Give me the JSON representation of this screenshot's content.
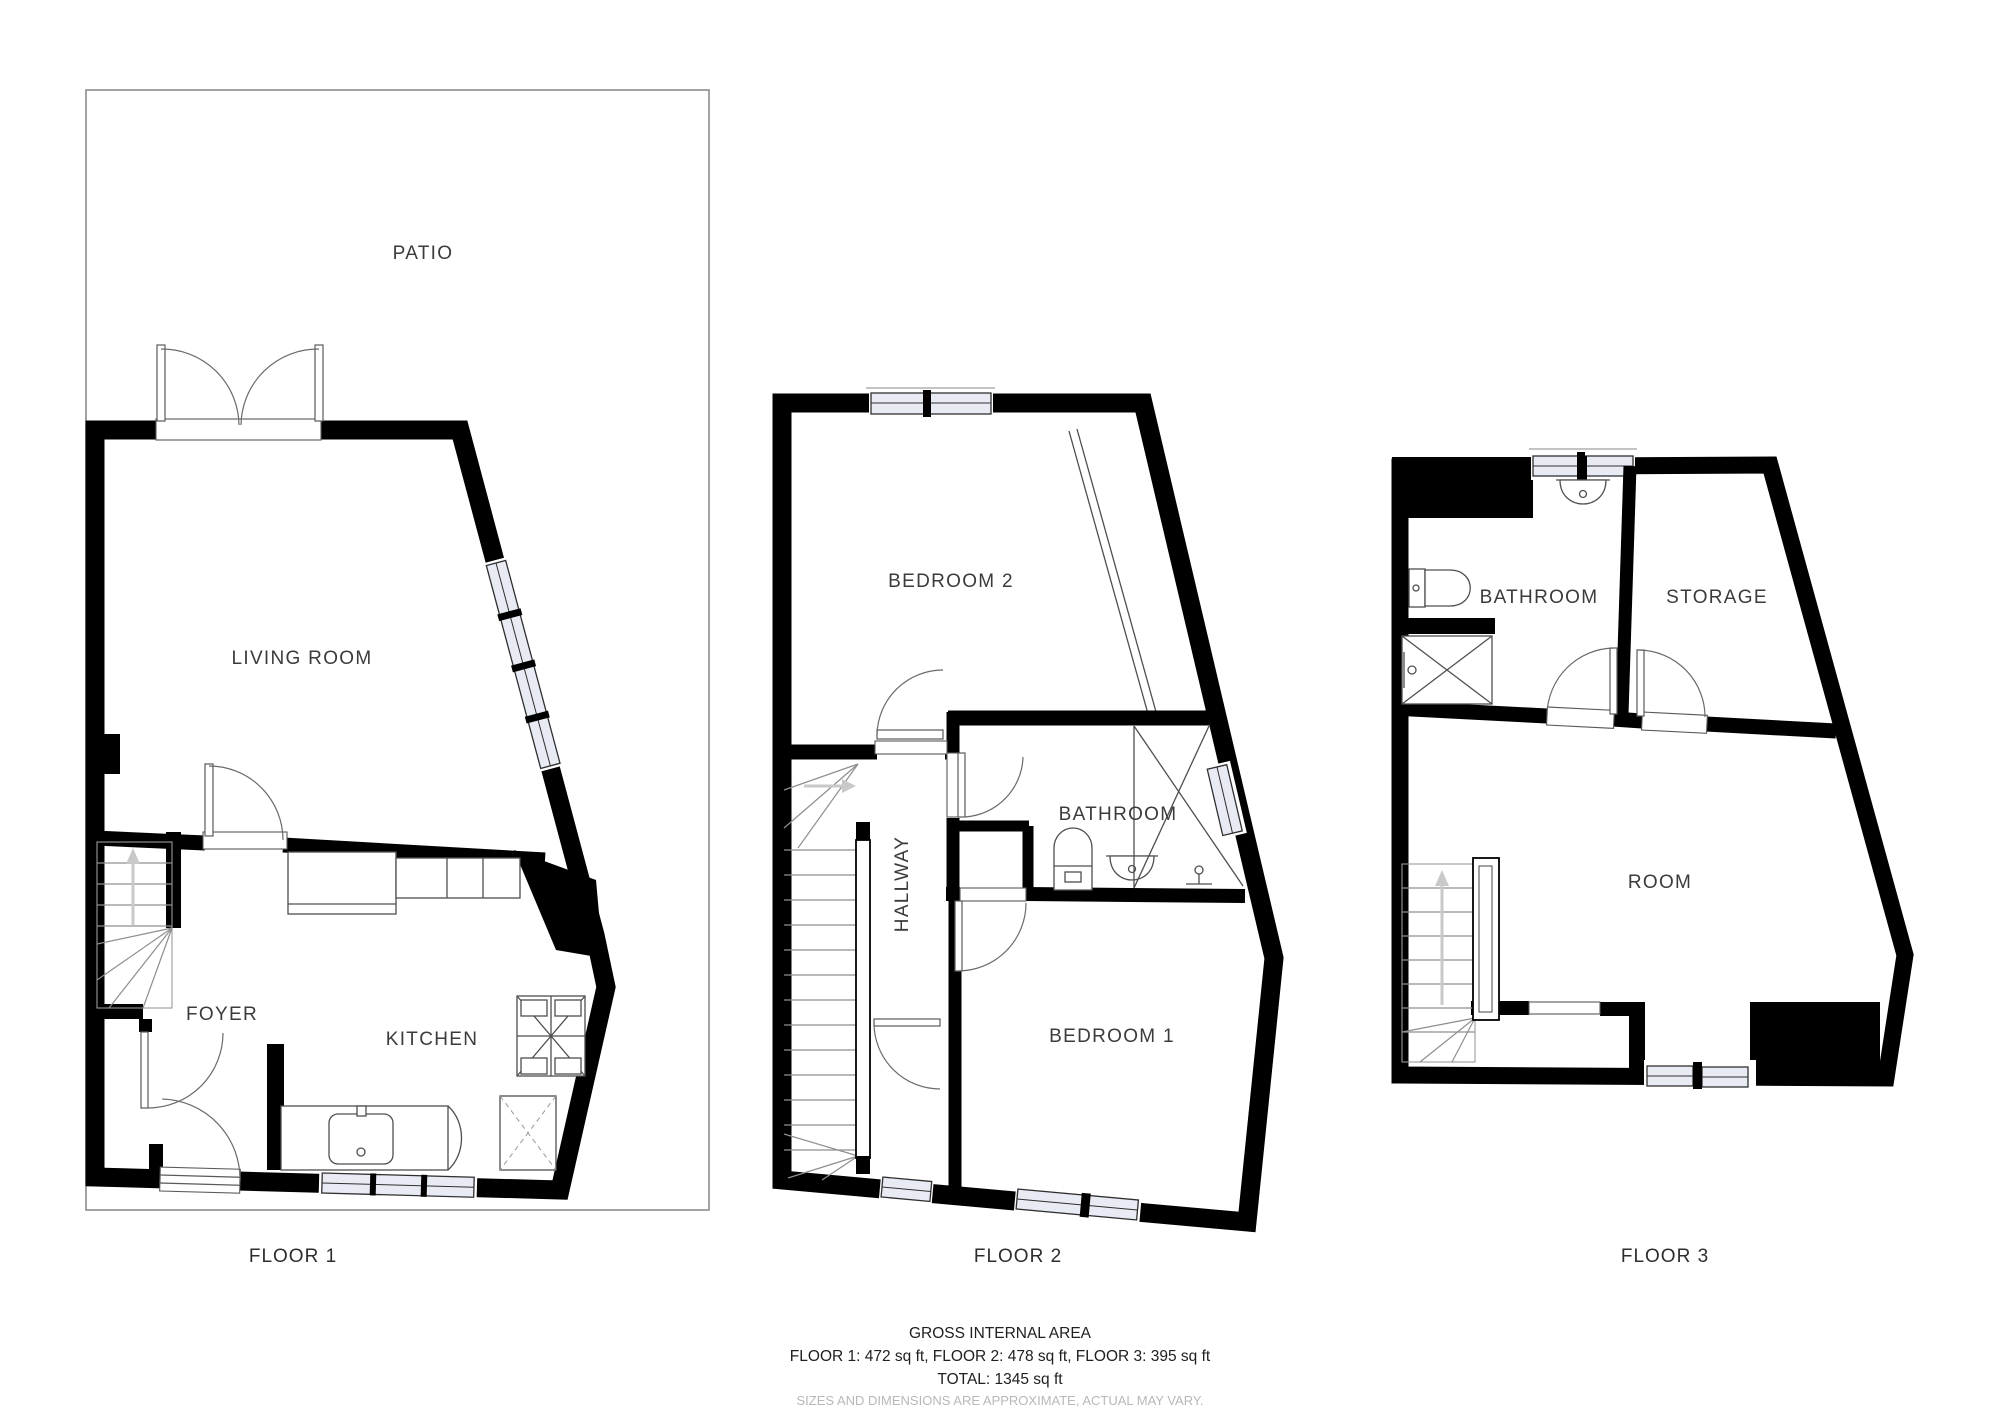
{
  "floors": [
    {
      "label": "FLOOR 1",
      "rooms": [
        "PATIO",
        "LIVING ROOM",
        "FOYER",
        "KITCHEN"
      ]
    },
    {
      "label": "FLOOR 2",
      "rooms": [
        "BEDROOM 2",
        "HALLWAY",
        "BATHROOM",
        "BEDROOM 1"
      ]
    },
    {
      "label": "FLOOR 3",
      "rooms": [
        "BATHROOM",
        "STORAGE",
        "ROOM"
      ]
    }
  ],
  "footer": {
    "title": "GROSS INTERNAL AREA",
    "areas": "FLOOR 1: 472 sq ft, FLOOR 2: 478 sq ft, FLOOR 3: 395 sq ft",
    "total": "TOTAL: 1345 sq ft",
    "disclaimer": "SIZES AND DIMENSIONS ARE APPROXIMATE, ACTUAL MAY VARY."
  },
  "colors": {
    "wall": "#000000",
    "window_fill": "#e8ebf4",
    "line": "#4f4f4f",
    "muted": "#b8b8b8"
  }
}
